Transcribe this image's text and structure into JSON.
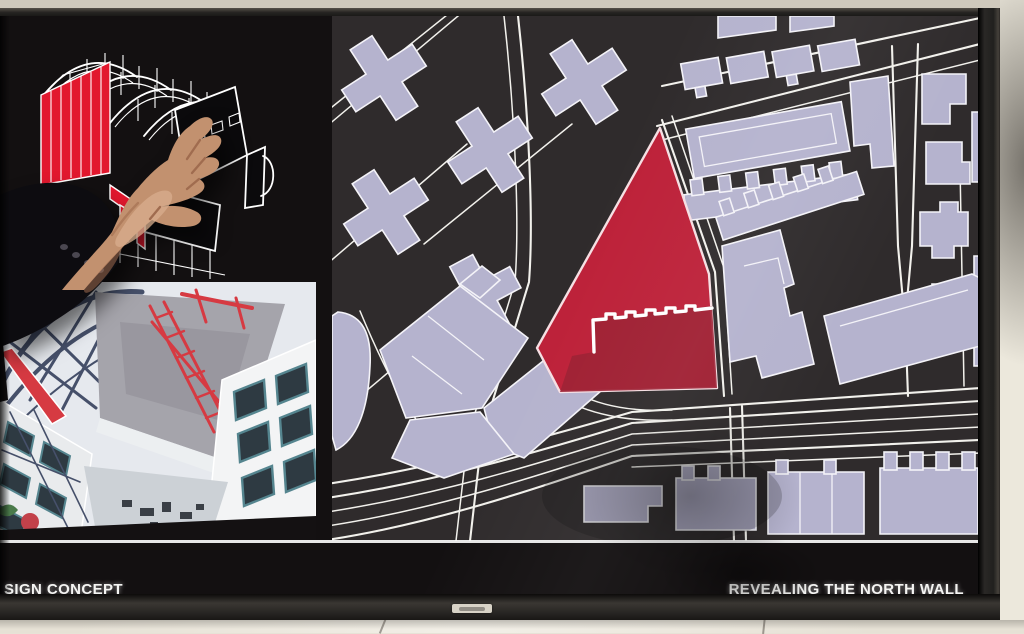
{
  "screen": {
    "bottom_bar": {
      "left_title": "SIGN CONCEPT",
      "right_title": "REVEALING THE NORTH WALL"
    }
  },
  "panels": {
    "axon": "axonometric building diagram with red highlighted wall",
    "photo": "construction site photograph",
    "map": "site plan map with red project site"
  },
  "colors": {
    "wall": "#e7e2d6",
    "wallTop": "#cfc9bc",
    "wallRight": "#ece8dc",
    "wallBottom": "#e6e1d5",
    "bezel": "#23211f",
    "bezelDark": "#161514",
    "bezelEdge": "#6d675d",
    "screenBg": "#131011",
    "mapBg": "#2f2b2c",
    "bldgFill": "#b5b3ce",
    "bldgLine": "#f4f3f8",
    "roadLine": "#f2f1ec",
    "siteRed": "#bd2139",
    "siteRedDark": "#9c2033",
    "siteOutline": "#f6dfe3",
    "axonRed": "#e2182e",
    "axonLine": "#ffffff",
    "skin": "#c2916f",
    "skinHi": "#d8ad8d",
    "skinSh": "#a06c4f",
    "sleeve": "#0d0c10",
    "photoBg": "#e6e9ee",
    "photoTruss": "#46506a",
    "photoRed": "#d63a42",
    "photoTeal": "#55858f",
    "photoDark": "#2e3a42",
    "titleText": "#f4f4f2",
    "brandPlate": "#d8d3c7"
  }
}
